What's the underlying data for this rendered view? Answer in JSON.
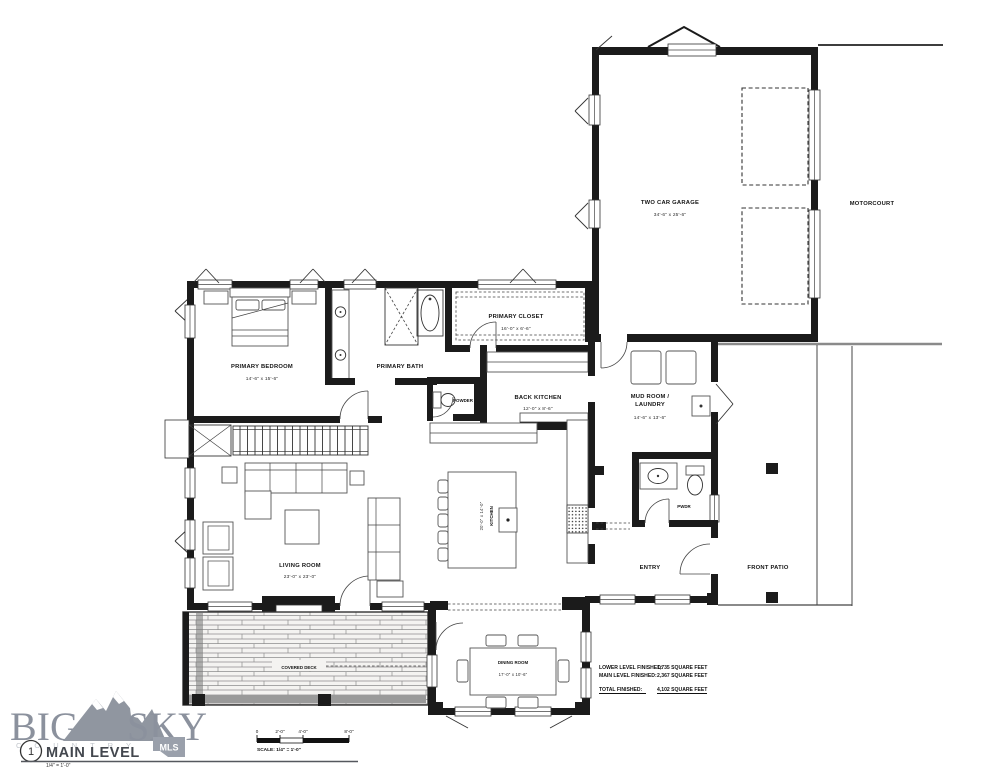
{
  "sheet": {
    "number": "1",
    "title": "MAIN LEVEL",
    "scale": "1/4\" = 1'-0\""
  },
  "logo": {
    "word_left": "BIG",
    "word_right": "SKY",
    "tagline": "COUNTRY",
    "badge": "MLS"
  },
  "scale_bar": {
    "ticks": [
      "0",
      "2'-0\"",
      "4'-0\"",
      "8'-0\""
    ],
    "caption": "SCALE: 1/4\" = 1'-0\""
  },
  "rooms": {
    "garage": {
      "name": "TWO CAR GARAGE",
      "dims": "34'-6\" x 25'-6\""
    },
    "motorcourt": {
      "name": "MOTORCOURT"
    },
    "primary_bedroom": {
      "name": "PRIMARY BEDROOM",
      "dims": "14'-6\" x 15'-6\""
    },
    "primary_bath": {
      "name": "PRIMARY BATH"
    },
    "primary_closet": {
      "name": "PRIMARY CLOSET",
      "dims": "16'-0\" x 6'-6\""
    },
    "powder": {
      "name": "POWDER"
    },
    "back_kitchen": {
      "name": "BACK KITCHEN",
      "dims": "12'-0\" x 8'-6\""
    },
    "mud_room": {
      "name_line1": "MUD ROOM /",
      "name_line2": "LAUNDRY",
      "dims": "14'-6\" x 13'-6\""
    },
    "kitchen": {
      "name": "KITCHEN",
      "dims": "20'-0\" x 14'-0\""
    },
    "living_room": {
      "name": "LIVING ROOM",
      "dims": "23'-0\" x 23'-0\""
    },
    "fireplace": {
      "name": "FIREPLACE"
    },
    "pwdr": {
      "name": "PWDR"
    },
    "entry": {
      "name": "ENTRY"
    },
    "front_patio": {
      "name": "FRONT PATIO"
    },
    "covered_deck": {
      "name": "COVERED DECK"
    },
    "dining_room": {
      "name": "DINING ROOM",
      "dims": "17'-0\" x 10'-6\""
    }
  },
  "area_table": {
    "rows": [
      {
        "label": "LOWER LEVEL FINISHED:",
        "value": "1,735 SQUARE FEET"
      },
      {
        "label": "MAIN LEVEL FINISHED:",
        "value": "2,367 SQUARE FEET"
      },
      {
        "label": "TOTAL FINISHED:",
        "value": "4,102 SQUARE FEET"
      }
    ]
  },
  "colors": {
    "line": "#1b1b1b",
    "logo_gray": "#8b919d",
    "badge_gray": "#9aa0ab"
  }
}
